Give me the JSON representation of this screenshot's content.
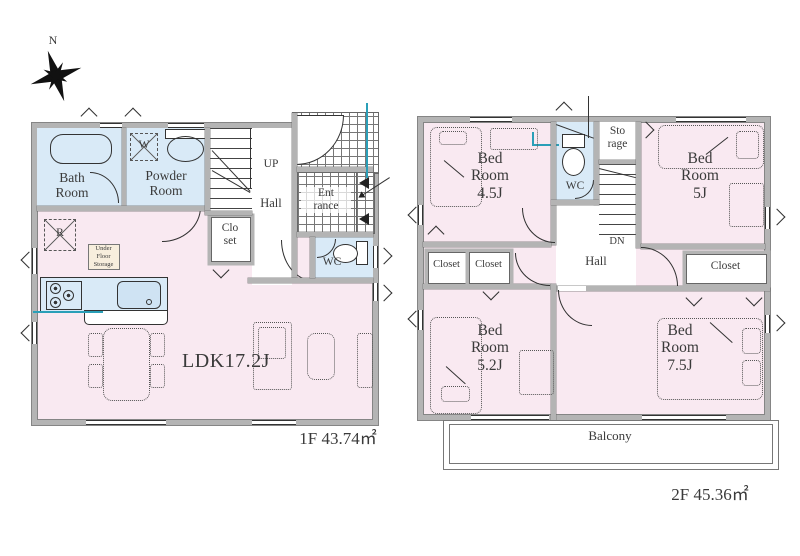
{
  "compass": {
    "north": "N"
  },
  "colors": {
    "room_pink": "#f9e9f1",
    "wet_area_blue": "#d9eaf7",
    "wall_gray": "#b4b4b4",
    "plumbing_teal": "#2a9fb8"
  },
  "floor1": {
    "area": "1F 43.74㎡",
    "bath": "Bath\nRoom",
    "powder": "Powder\nRoom",
    "washer": "W",
    "up": "UP",
    "hall": "Hall",
    "entrance": "Ent\nrance",
    "closet": "Clo\nset",
    "wc": "WC",
    "fridge": "R",
    "under_floor_storage": "Under\nFloor\nStorage",
    "ldk": "LDK17.2J"
  },
  "floor2": {
    "area": "2F 45.36㎡",
    "bedroom_45": "Bed\nRoom\n4.5J",
    "bedroom_5": "Bed\nRoom\n5J",
    "bedroom_52": "Bed\nRoom\n5.2J",
    "bedroom_75": "Bed\nRoom\n7.5J",
    "wc": "WC",
    "storage": "Sto\nrage",
    "dn": "DN",
    "hall": "Hall",
    "closet_left_1": "Closet",
    "closet_left_2": "Closet",
    "closet_right": "Closet",
    "balcony": "Balcony"
  }
}
